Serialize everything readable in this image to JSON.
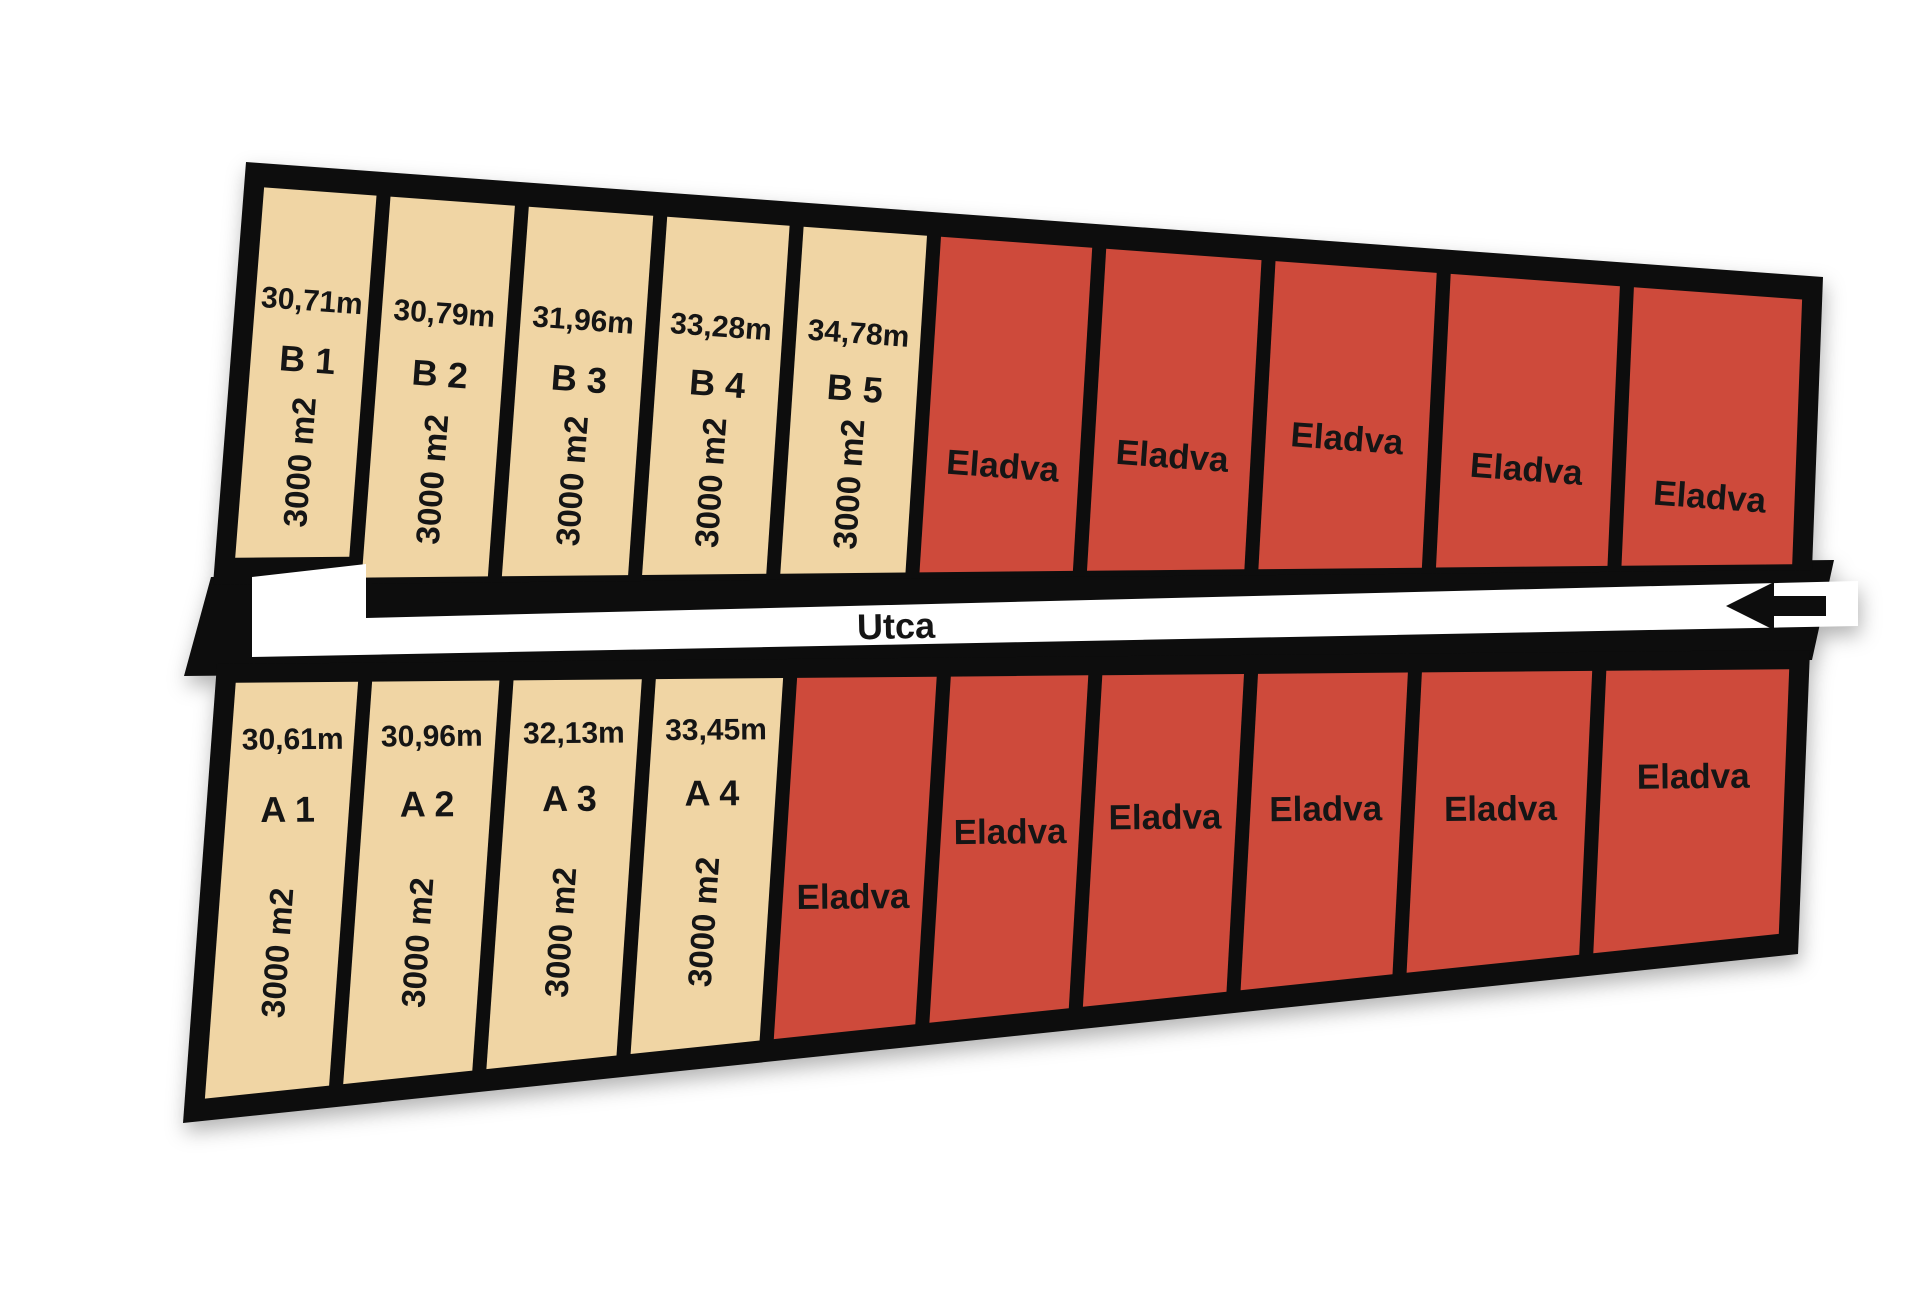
{
  "diagram": {
    "street": {
      "label": "Utca"
    },
    "colors": {
      "available": "#F0D5A4",
      "sold": "#CE4A3B",
      "outline": "#0D0D0D",
      "street": "#FFFFFF",
      "text": "#151515",
      "background": "#FFFFFF"
    },
    "rows": [
      {
        "id": "B",
        "position": "top",
        "plots": [
          {
            "status": "available",
            "name": "B 1",
            "width_label": "30,71m",
            "area_label": "3000 m2"
          },
          {
            "status": "available",
            "name": "B 2",
            "width_label": "30,79m",
            "area_label": "3000 m2"
          },
          {
            "status": "available",
            "name": "B 3",
            "width_label": "31,96m",
            "area_label": "3000 m2"
          },
          {
            "status": "available",
            "name": "B 4",
            "width_label": "33,28m",
            "area_label": "3000 m2"
          },
          {
            "status": "available",
            "name": "B 5",
            "width_label": "34,78m",
            "area_label": "3000 m2"
          },
          {
            "status": "sold",
            "label": "Eladva"
          },
          {
            "status": "sold",
            "label": "Eladva"
          },
          {
            "status": "sold",
            "label": "Eladva"
          },
          {
            "status": "sold",
            "label": "Eladva"
          },
          {
            "status": "sold",
            "label": "Eladva"
          }
        ]
      },
      {
        "id": "A",
        "position": "bottom",
        "plots": [
          {
            "status": "available",
            "name": "A 1",
            "width_label": "30,61m",
            "area_label": "3000 m2"
          },
          {
            "status": "available",
            "name": "A 2",
            "width_label": "30,96m",
            "area_label": "3000 m2"
          },
          {
            "status": "available",
            "name": "A 3",
            "width_label": "32,13m",
            "area_label": "3000 m2"
          },
          {
            "status": "available",
            "name": "A 4",
            "width_label": "33,45m",
            "area_label": "3000 m2"
          },
          {
            "status": "sold",
            "label": "Eladva"
          },
          {
            "status": "sold",
            "label": "Eladva"
          },
          {
            "status": "sold",
            "label": "Eladva"
          },
          {
            "status": "sold",
            "label": "Eladva"
          },
          {
            "status": "sold",
            "label": "Eladva"
          },
          {
            "status": "sold",
            "label": "Eladva"
          }
        ]
      }
    ]
  }
}
